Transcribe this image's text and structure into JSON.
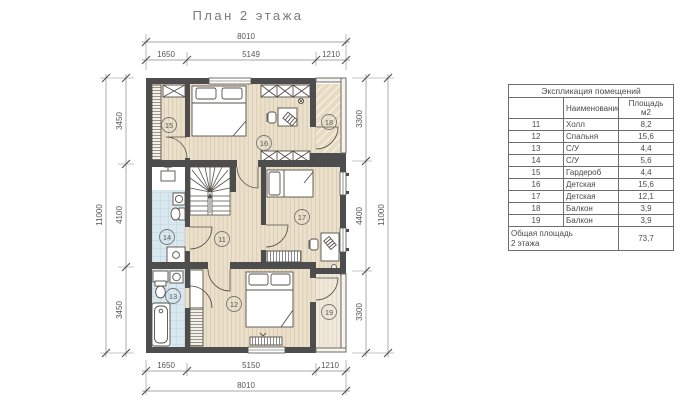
{
  "title": "План 2 этажа",
  "dims": {
    "top": {
      "total": "8010",
      "segments": [
        "1650",
        "5149",
        "1210"
      ]
    },
    "bottom": {
      "total": "8010",
      "segments": [
        "1650",
        "5150",
        "1210"
      ]
    },
    "left": {
      "total": "11000",
      "segments": [
        "3450",
        "4100",
        "3450"
      ]
    },
    "right": {
      "total": "11000",
      "segments": [
        "3300",
        "4400",
        "3300"
      ]
    }
  },
  "legend": {
    "title": "Экспликация помещений",
    "columns": {
      "name": "Наименование",
      "area_line1": "Площадь",
      "area_line2": "м2"
    },
    "rows": [
      {
        "num": "11",
        "name": "Холл",
        "area": "8,2"
      },
      {
        "num": "12",
        "name": "Спальня",
        "area": "15,6"
      },
      {
        "num": "13",
        "name": "С/У",
        "area": "4,4"
      },
      {
        "num": "14",
        "name": "С/У",
        "area": "5,6"
      },
      {
        "num": "15",
        "name": "Гардероб",
        "area": "4,4"
      },
      {
        "num": "16",
        "name": "Детская",
        "area": "15,6"
      },
      {
        "num": "17",
        "name": "Детская",
        "area": "12,1"
      },
      {
        "num": "18",
        "name": "Балкон",
        "area": "3,9"
      },
      {
        "num": "19",
        "name": "Балкон",
        "area": "3,9"
      }
    ],
    "footer": {
      "label_line1": "Общая площадь",
      "label_line2": "2 этажа",
      "area": "73,7"
    }
  },
  "colors": {
    "wall": "#4d4d4d",
    "floor": "#ebe0cb",
    "floor_line": "#d9caae",
    "tile": "#d9e7ee",
    "balcony": "#e7dcc3",
    "dim_text": "#555555",
    "furniture_line": "#55504a"
  }
}
